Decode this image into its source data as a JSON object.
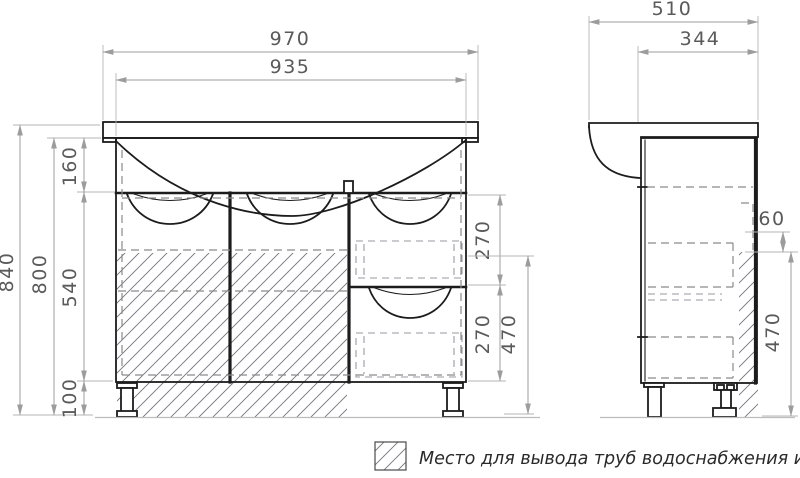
{
  "colors": {
    "geometry": "#1c1c1c",
    "dashed_lines": "#8a8a8a",
    "dimension_lines": "#9c9c9c",
    "dimension_text": "#5a5a5a",
    "hatch": "#74747e"
  },
  "front_view": {
    "dims": {
      "overall_width": "970",
      "basin_width": "935",
      "overall_height": "840",
      "cabinet_height": "800",
      "apron_height": "160",
      "door_height": "540",
      "leg_height": "100",
      "drawer_upper_height": "270",
      "drawer_lower_height": "270",
      "pipe_zone_height": "470"
    }
  },
  "side_view": {
    "dims": {
      "overall_depth": "510",
      "cabinet_depth": "344",
      "pipe_gap": "60",
      "pipe_zone_height": "470"
    }
  },
  "legend": {
    "icon": "hatch-swatch-icon",
    "text": "Место для вывода труб водоснабжения и канализации"
  }
}
